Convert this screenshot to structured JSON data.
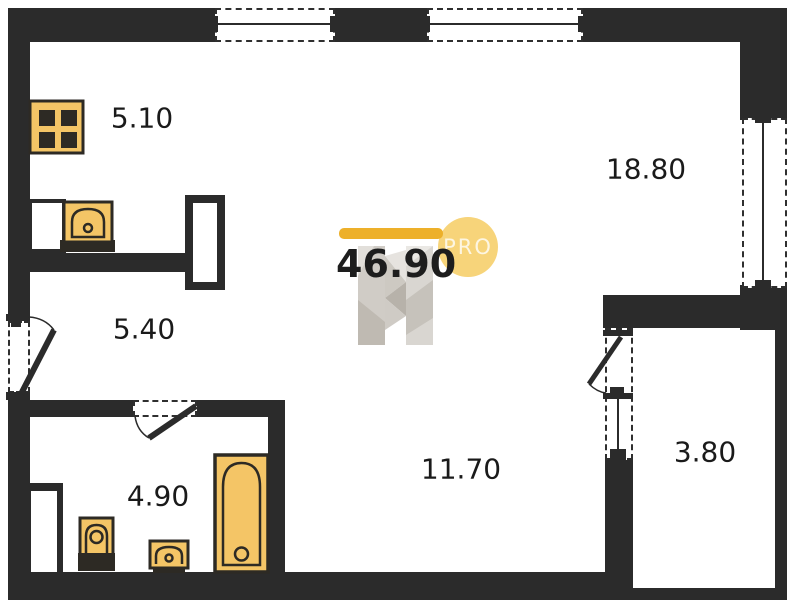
{
  "plan": {
    "title": "apartment-floor-plan",
    "total": {
      "area": "46.90",
      "badge": "PRO"
    },
    "rooms": [
      {
        "name": "kitchen",
        "area": "5.10"
      },
      {
        "name": "living-room",
        "area": "18.80"
      },
      {
        "name": "hallway",
        "area": "5.40"
      },
      {
        "name": "bathroom",
        "area": "4.90"
      },
      {
        "name": "room",
        "area": "11.70"
      },
      {
        "name": "balcony",
        "area": "3.80"
      }
    ],
    "icons": {
      "stove-icon": "four-burner cooktop grid",
      "kitchen-sink-icon": "arched sink with drain dot",
      "toilet-icon": "toilet bowl with tank",
      "bathroom-sink-icon": "small arched washbasin",
      "bathtub-icon": "bathtub with drain",
      "watermark-logo": "faceted letter-H developer logo"
    },
    "colors": {
      "wall": "#2b2b2b",
      "fixture_fill": "#f4c566",
      "fixture_stroke": "#2d2a24",
      "accent_bar": "#edb02a",
      "badge_circle": "#f7d47a",
      "badge_text": "rgba(255,255,255,0.78)",
      "label_text": "#1a1a1a",
      "watermark_gray": "#cdc9c2"
    }
  }
}
